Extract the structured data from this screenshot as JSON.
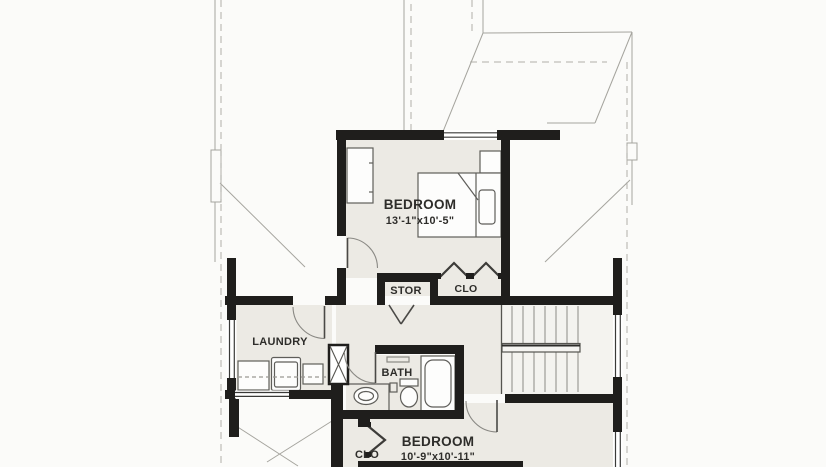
{
  "plan": {
    "type": "floor-plan",
    "rooms": {
      "bedroom1": {
        "label": "BEDROOM",
        "dims": "13'-1\"x10'-5\""
      },
      "bedroom2": {
        "label": "BEDROOM",
        "dims": "10'-9\"x10'-11\""
      },
      "laundry": {
        "label": "LAUNDRY"
      },
      "bath": {
        "label": "BATH"
      },
      "storage": {
        "label": "STOR"
      },
      "closet1": {
        "label": "CLO"
      },
      "closet2": {
        "label": "CLO"
      }
    },
    "colors": {
      "wall": "#1f1e1c",
      "floor": "#eceae4",
      "stair_floor": "#f4f3ef",
      "paper": "#fbfbf9",
      "roof_line": "#a5a49e",
      "fixture_line": "#5f5e5a",
      "text": "#2e2d2a"
    }
  }
}
